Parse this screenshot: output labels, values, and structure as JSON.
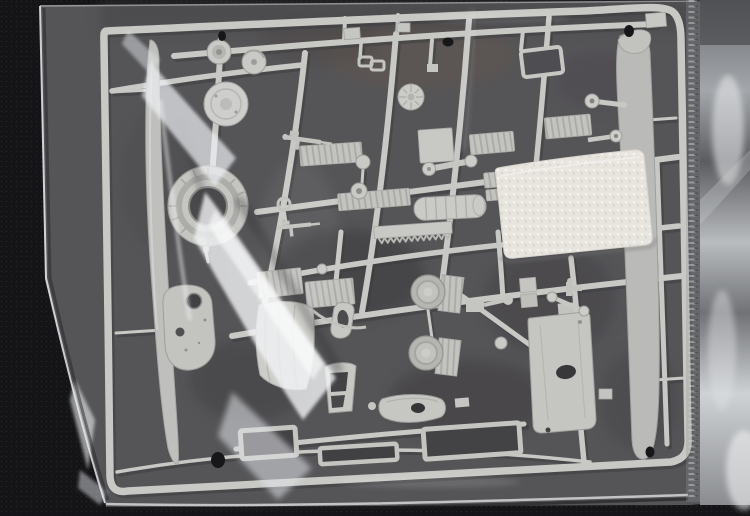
{
  "image": {
    "kind": "photograph",
    "alt": "Unbuilt light-grey model kit sprue with helicopter parts - rotor blades, engine cowl ring, wheels, fuselage and canopy pieces - sealed in a clear polyethylene bag with a small white foam pad, lying on a dark woven surface",
    "objects": {
      "surface": "dark woven tabletop",
      "bag": "clear plastic bag with glossy wrinkles",
      "bag_seam": "crimped seam near the right edge",
      "sprue": "light grey injection-moulded parts frame",
      "foam_pad": "white foam cushion strip",
      "parts": [
        "left rotor blade",
        "right rotor blade",
        "engine cowl ring",
        "gearbox dome",
        "hub discs",
        "finned wheel hub",
        "wheels with mudguards",
        "ribbed deck plates",
        "toothed rack strip",
        "fuel tank cylinder",
        "cabin floor plate",
        "fuselage float with portholes",
        "canopy frames",
        "curved door panel",
        "small hull fairing",
        "window frames",
        "machine-gun details",
        "control arms and levers"
      ]
    },
    "colors": {
      "surface": "#141417",
      "bag_interior": "#4e4e51",
      "plastic": "#c8c9c5",
      "plastic_shadow": "#8e8f8b",
      "foam": "#eae7e1",
      "sheen": "#eef0f3",
      "foil": "#b9bcc0",
      "hole": "#0c0c0e"
    }
  }
}
